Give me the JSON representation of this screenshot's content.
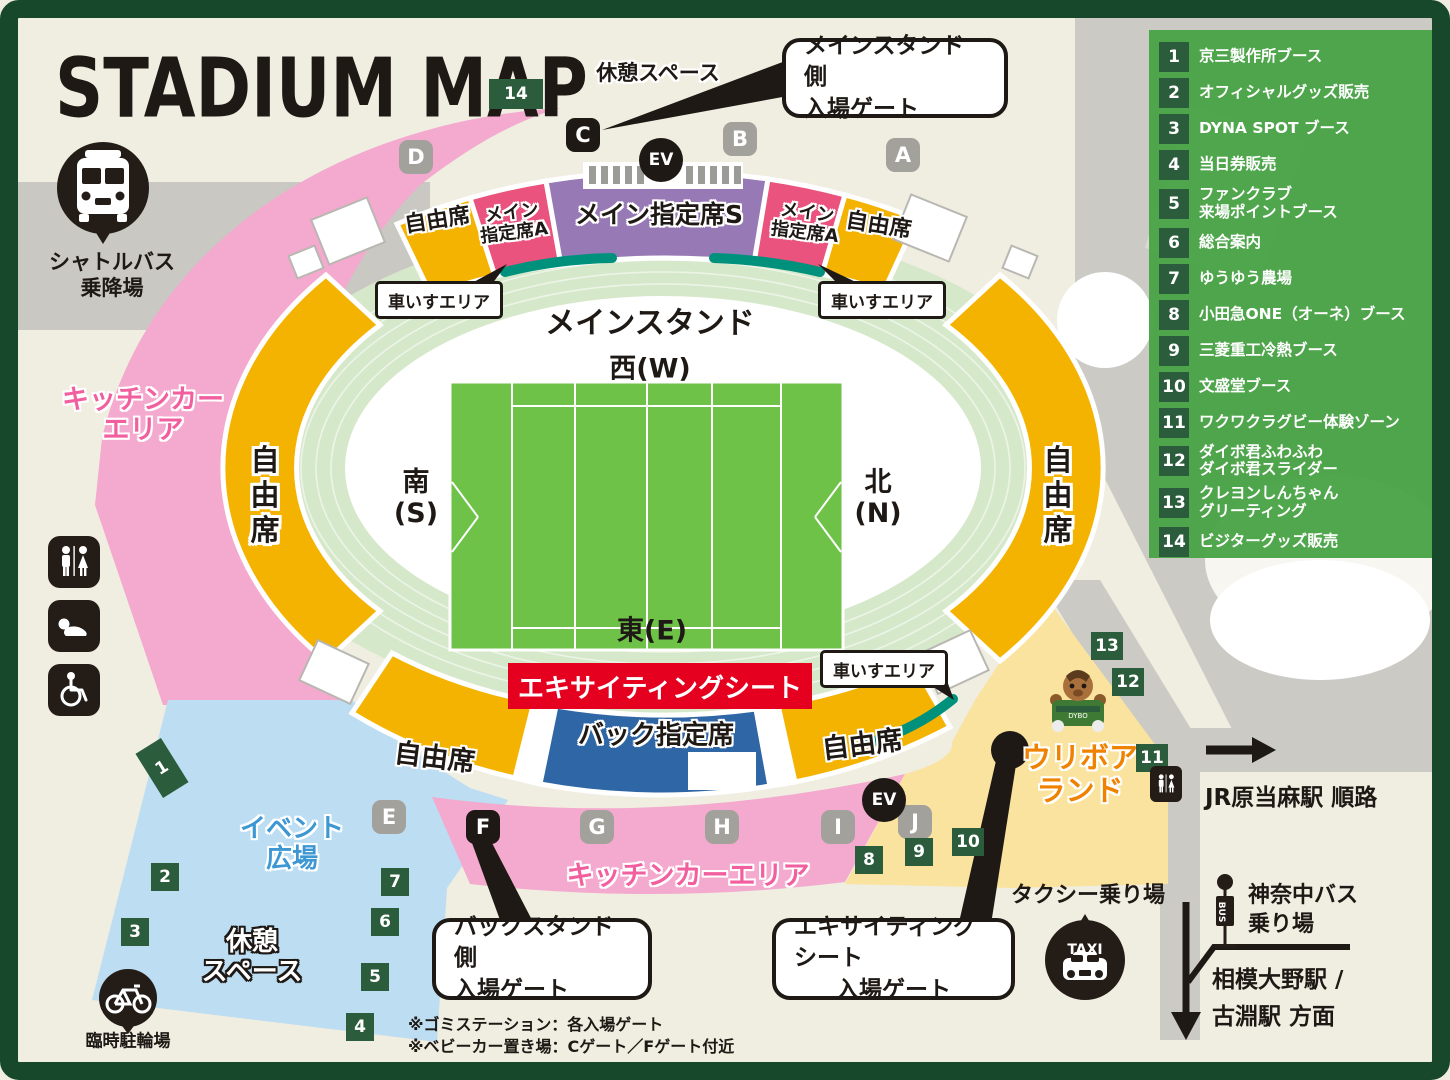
{
  "title": "STADIUM MAP",
  "legend": {
    "items": [
      {
        "num": "1",
        "label": "京三製作所ブース"
      },
      {
        "num": "2",
        "label": "オフィシャルグッズ販売"
      },
      {
        "num": "3",
        "label": "DYNA SPOT ブース"
      },
      {
        "num": "4",
        "label": "当日券販売"
      },
      {
        "num": "5",
        "label": "ファンクラブ",
        "line2": "来場ポイントブース"
      },
      {
        "num": "6",
        "label": "総合案内"
      },
      {
        "num": "7",
        "label": "ゆうゆう農場"
      },
      {
        "num": "8",
        "label": "小田急ONE（オーネ）ブース"
      },
      {
        "num": "9",
        "label": "三菱重工冷熱ブース"
      },
      {
        "num": "10",
        "label": "文盛堂ブース"
      },
      {
        "num": "11",
        "label": "ワクワクラグビー体験ゾーン"
      },
      {
        "num": "12",
        "label": "ダイボ君ふわふわ",
        "line2": "ダイボ君スライダー"
      },
      {
        "num": "13",
        "label": "クレヨンしんちゃん",
        "line2": "グリーティング"
      },
      {
        "num": "14",
        "label": "ビジターグッズ販売"
      }
    ]
  },
  "gates": {
    "a": "A",
    "b": "B",
    "c": "C",
    "d": "D",
    "e": "E",
    "f": "F",
    "g": "G",
    "h": "H",
    "i": "I",
    "j": "J",
    "ev": "EV"
  },
  "markers": [
    "1",
    "2",
    "3",
    "4",
    "5",
    "6",
    "7",
    "8",
    "9",
    "10",
    "11",
    "12",
    "13",
    "14"
  ],
  "stadium": {
    "main_stand_label": "メインスタンド",
    "west": "西(W)",
    "east": "東(E)",
    "south_l1": "南",
    "south_l2": "(S)",
    "north_l1": "北",
    "north_l2": "(N)",
    "free_seat": "自由席",
    "main_a_l1": "メイン",
    "main_a_l2": "指定席A",
    "main_s": "メイン指定席S",
    "back_reserved": "バック指定席",
    "exciting_seat": "エキサイティングシート",
    "wheelchair": "車いすエリア"
  },
  "areas": {
    "kitchen_l1": "キッチンカー",
    "kitchen_l2": "エリア",
    "kitchen_bottom": "キッチンカーエリア",
    "event_l1": "イベント",
    "event_l2": "広場",
    "rest_top": "休憩スペース",
    "rest_l1": "休憩",
    "rest_l2": "スペース",
    "uriboa_l1": "ウリボア",
    "uriboa_l2": "ランド"
  },
  "callouts": {
    "main_l1": "メインスタンド側",
    "main_l2": "入場ゲート",
    "back_l1": "バックスタンド側",
    "back_l2": "入場ゲート",
    "exciting_l1": "エキサイティングシート",
    "exciting_l2": "入場ゲート"
  },
  "transport": {
    "shuttle_l1": "シャトルバス",
    "shuttle_l2": "乗降場",
    "bike_parking": "臨時駐輪場",
    "taxi_stand": "タクシー乗り場",
    "taxi_sign": "TAXI",
    "bus_stop_l1": "神奈中バス",
    "bus_stop_l2": "乗り場",
    "bus_sign": "BUS",
    "jr_route": "JR原当麻駅 順路",
    "sagami_l1": "相模大野駅 /",
    "sagami_l2": "古淵駅 方面"
  },
  "notes": [
    "※ゴミステーション：各入場ゲート",
    "※ベビーカー置き場：Cゲート／Fゲート付近"
  ],
  "colors": {
    "frame": "#17482B",
    "ground": "#F0EDE1",
    "legend_green": "#4AA346",
    "marker_green": "#2B5C3B",
    "free_seat_yellow": "#F5B301",
    "main_a_pink": "#E9537D",
    "main_s_purple": "#9679B5",
    "back_blue": "#2F66A6",
    "exciting_red": "#E50020",
    "wheelchair_teal": "#00917C",
    "kitchen_pink": "#F4A9CE",
    "event_blue": "#BCDDF2",
    "uriboa_yellow": "#FAE39E",
    "field_green": "#6DC247",
    "concourse_green": "#D6E8CA",
    "road_gray": "#CBCAC5",
    "gate_gray": "#A3A19C",
    "ink": "#1E1915",
    "kitchen_text_pink": "#F25F9F",
    "event_text_blue": "#3D97D3",
    "uriboa_text_orange": "#EF8200"
  }
}
